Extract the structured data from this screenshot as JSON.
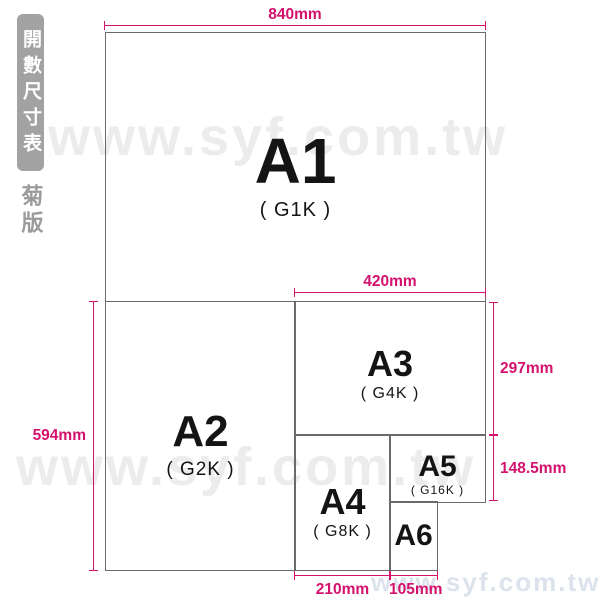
{
  "sidebar": {
    "title": "開數尺寸表",
    "edition": "菊版"
  },
  "watermark": {
    "text": "www.syf.com.tw"
  },
  "papers": {
    "a1": {
      "label": "A1",
      "sub": "( G1K )"
    },
    "a2": {
      "label": "A2",
      "sub": "( G2K )"
    },
    "a3": {
      "label": "A3",
      "sub": "( G4K )"
    },
    "a4": {
      "label": "A4",
      "sub": "( G8K )"
    },
    "a5": {
      "label": "A5",
      "sub": "( G16K )"
    },
    "a6": {
      "label": "A6"
    }
  },
  "dims": {
    "w840": "840mm",
    "w420": "420mm",
    "h594": "594mm",
    "h297": "297mm",
    "h1485": "148.5mm",
    "w210": "210mm",
    "w105": "105mm"
  },
  "colors": {
    "accent_pink": "#d4126e",
    "box_border": "#6a6a6a",
    "sidebar_gray": "#a2a2a2",
    "watermark_gray": "#ececec",
    "watermark_footer": "#dce3ec",
    "label_black": "#141414"
  }
}
